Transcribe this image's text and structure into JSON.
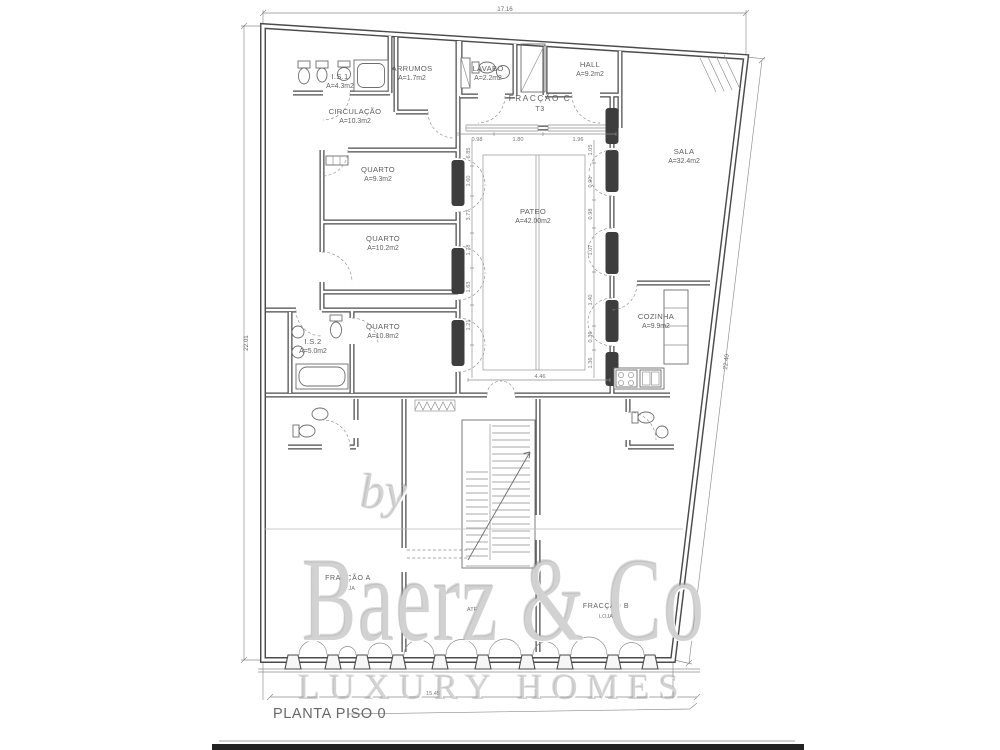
{
  "drawing": {
    "title": "PLANTA PISO 0",
    "colors": {
      "line": "#4b4b4b",
      "thin_line": "#8c8c8c",
      "label_text": "#5f5f5f",
      "watermark": "#aeaeae",
      "footer_bar": "#232323"
    }
  },
  "watermark": {
    "by": "by",
    "brand": "Baerz & Co",
    "tagline": "LUXURY HOMES"
  },
  "overall_dimensions": {
    "top": "17.16",
    "left": "22.01",
    "right": "22.40",
    "bottom": "15.45"
  },
  "fractions": {
    "c": {
      "name": "FRACÇÃO C",
      "type": "T3"
    },
    "a": {
      "name": "FRACÇÃO A",
      "use": "LOJA"
    },
    "b": {
      "name": "FRACÇÃO B",
      "use": "LOJA"
    },
    "stairwell": "ATF"
  },
  "rooms": [
    {
      "name": "I.S.1",
      "area": "A=4.3m2"
    },
    {
      "name": "ARRUMOS",
      "area": "A=1.7m2"
    },
    {
      "name": "LAVABO",
      "area": "A=2.2m2"
    },
    {
      "name": "HALL",
      "area": "A=9.2m2"
    },
    {
      "name": "CIRCULAÇÃO",
      "area": "A=10.3m2"
    },
    {
      "name": "QUARTO",
      "area": "A=9.3m2"
    },
    {
      "name": "QUARTO",
      "area": "A=10.2m2"
    },
    {
      "name": "QUARTO",
      "area": "A=10.8m2"
    },
    {
      "name": "I.S.2",
      "area": "A=5.0m2"
    },
    {
      "name": "PATEO",
      "area": "A=42.00m2"
    },
    {
      "name": "SALA",
      "area": "A=32.4m2"
    },
    {
      "name": "COZINHA",
      "area": "A=9.9m2"
    }
  ],
  "pateo_dims": {
    "top": [
      "0.98",
      "1.80",
      "1.96"
    ],
    "left": [
      "6.85",
      "1.60",
      "3.77",
      "1.78",
      "1.63",
      "1.21"
    ],
    "right": [
      "1.05",
      "0.90",
      "0.98",
      "1.07",
      "1.40",
      "0.36",
      "1.36"
    ],
    "bottom": "4.46"
  }
}
